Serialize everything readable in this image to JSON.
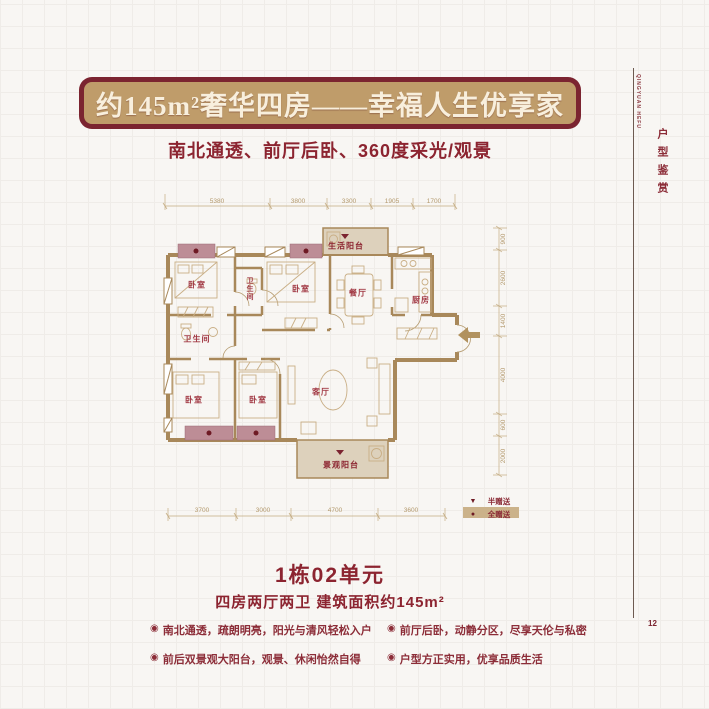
{
  "header": {
    "title": "约145m²奢华四房——幸福人生优享家",
    "subtitle": "南北通透、前厅后卧、360度采光/观景"
  },
  "sidebar": {
    "english": "QINGYUAN HEFU",
    "vertical_title": "户型鉴赏",
    "page_number": "12"
  },
  "floorplan": {
    "rooms": {
      "bedroom1": "卧室",
      "bath2": "卫生间",
      "bedroom2": "卧室",
      "dining": "餐厅",
      "kitchen": "厨房",
      "life_balcony": "生活阳台",
      "bath1": "卫生间",
      "bedroom3": "卧室",
      "bedroom4": "卧室",
      "living": "客厅",
      "view_balcony": "景观阳台"
    },
    "dims_top": [
      "5380",
      "3800",
      "3300",
      "1905",
      "1700"
    ],
    "dims_right": [
      "900",
      "2600",
      "1400",
      "4000",
      "600",
      "2000"
    ],
    "dims_bottom": [
      "3700",
      "3000",
      "4700",
      "3600"
    ],
    "legend": {
      "half_marker": "▼",
      "half_label": "半赠送",
      "full_marker": "●",
      "full_label": "全赠送"
    }
  },
  "unit": {
    "name": "1栋02单元",
    "spec": "四房两厅两卫 建筑面积约145m²"
  },
  "features": [
    {
      "icon": "◉",
      "text": "南北通透，疏朗明亮，阳光与清风轻松入户"
    },
    {
      "icon": "◉",
      "text": "前厅后卧，动静分区，尽享天伦与私密"
    },
    {
      "icon": "◉",
      "text": "前后双景观大阳台，观景、休闲怡然自得"
    },
    {
      "icon": "◉",
      "text": "户型方正实用，优享品质生活"
    }
  ]
}
